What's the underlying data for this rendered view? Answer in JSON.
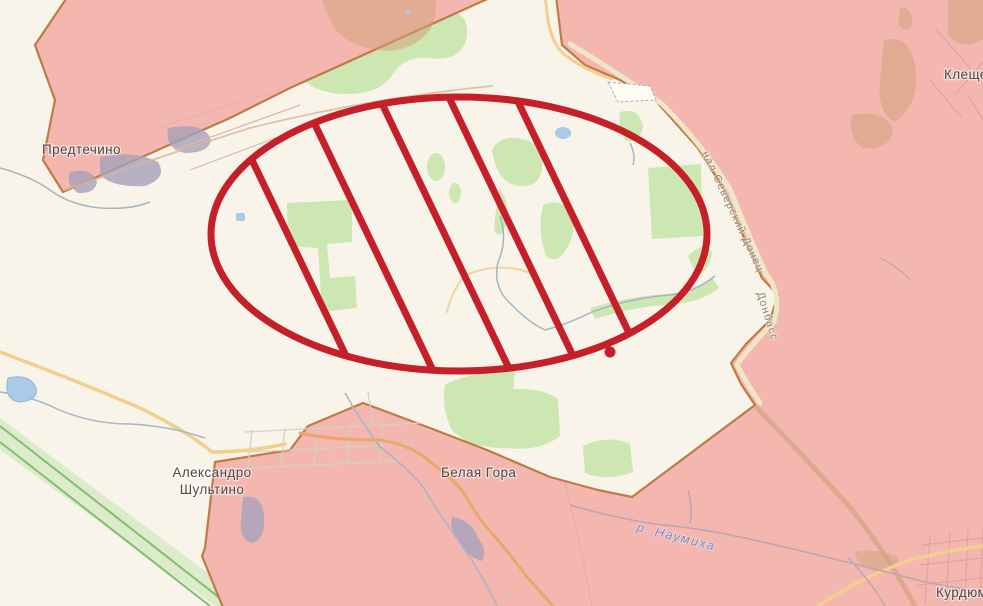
{
  "map": {
    "labels": {
      "predtechino": "Предтечино",
      "kleshcheevka": "Клещеевка",
      "aleksandro_line1": "Александро",
      "aleksandro_line2": "Шультино",
      "belaya_gora": "Белая Гора",
      "kurdyumovka": "Курдюмовка",
      "canal_upper": "нал Северский Донец",
      "canal_lower": "Донбасс",
      "river_naumikha": "р. Наумиха"
    },
    "colors": {
      "occupied_fill": "#f3b7b0",
      "occupied_border": "#bf7b45",
      "free_area": "#f8f4ea",
      "forest": "#cde7b2",
      "water": "#a9cbe8",
      "stream": "#a3b6c4",
      "road_yellow": "#f0d08c",
      "road_orange": "#e9a76a",
      "railway_green": "#86bb72",
      "annotation_red": "#c5202a"
    },
    "annotation": {
      "type": "hatched-ellipse",
      "cx": 459,
      "cy": 234,
      "rx": 248,
      "ry": 137,
      "stroke_width": 7,
      "hatch_slope": 0.48,
      "hatch_positions_x": [
        288,
        368,
        445,
        515,
        582
      ],
      "dot": {
        "x": 610,
        "y": 352,
        "r": 5.5
      }
    }
  }
}
